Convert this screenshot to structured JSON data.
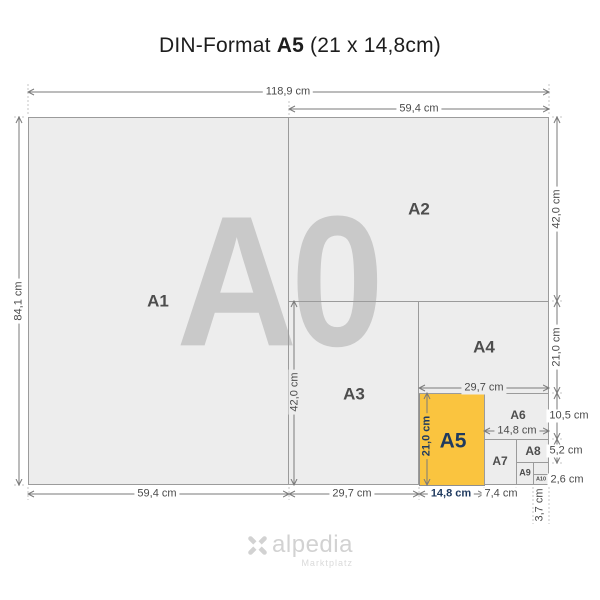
{
  "title": {
    "prefix": "DIN-Format",
    "format": "A5",
    "size": "(21 x 14,8cm)"
  },
  "watermark": "A0",
  "labels": {
    "a1": "A1",
    "a2": "A2",
    "a3": "A3",
    "a4": "A4",
    "a5": "A5",
    "a6": "A6",
    "a7": "A7",
    "a8": "A8",
    "a9": "A9",
    "a10": "A10"
  },
  "dimensions": {
    "top_total": "118,9 cm",
    "top_half": "59,4 cm",
    "left_height": "84,1 cm",
    "right_a2_height": "42,0 cm",
    "right_a4_height": "21,0 cm",
    "right_a6_height": "10,5 cm",
    "right_a8_height": "5,2 cm",
    "right_a10_height": "2,6 cm",
    "inner_a3_height": "42,0 cm",
    "inner_a4_width": "29,7 cm",
    "inner_a5_height": "21,0 cm",
    "inner_a6_width": "14,8 cm",
    "bottom_a1_width": "59,4 cm",
    "bottom_a3_width": "29,7 cm",
    "bottom_a5_width": "14,8 cm",
    "bottom_a7_width": "7,4 cm",
    "bottom_a10_width": "3,7 cm"
  },
  "colors": {
    "highlight": "#FAC43F",
    "navy": "#1F3A5F",
    "sheet": "#EDEDED",
    "line": "#9B9B9B",
    "watermark": "#C9C9C9"
  },
  "logo": {
    "name": "alpedia",
    "tagline": "Marktplatz"
  }
}
